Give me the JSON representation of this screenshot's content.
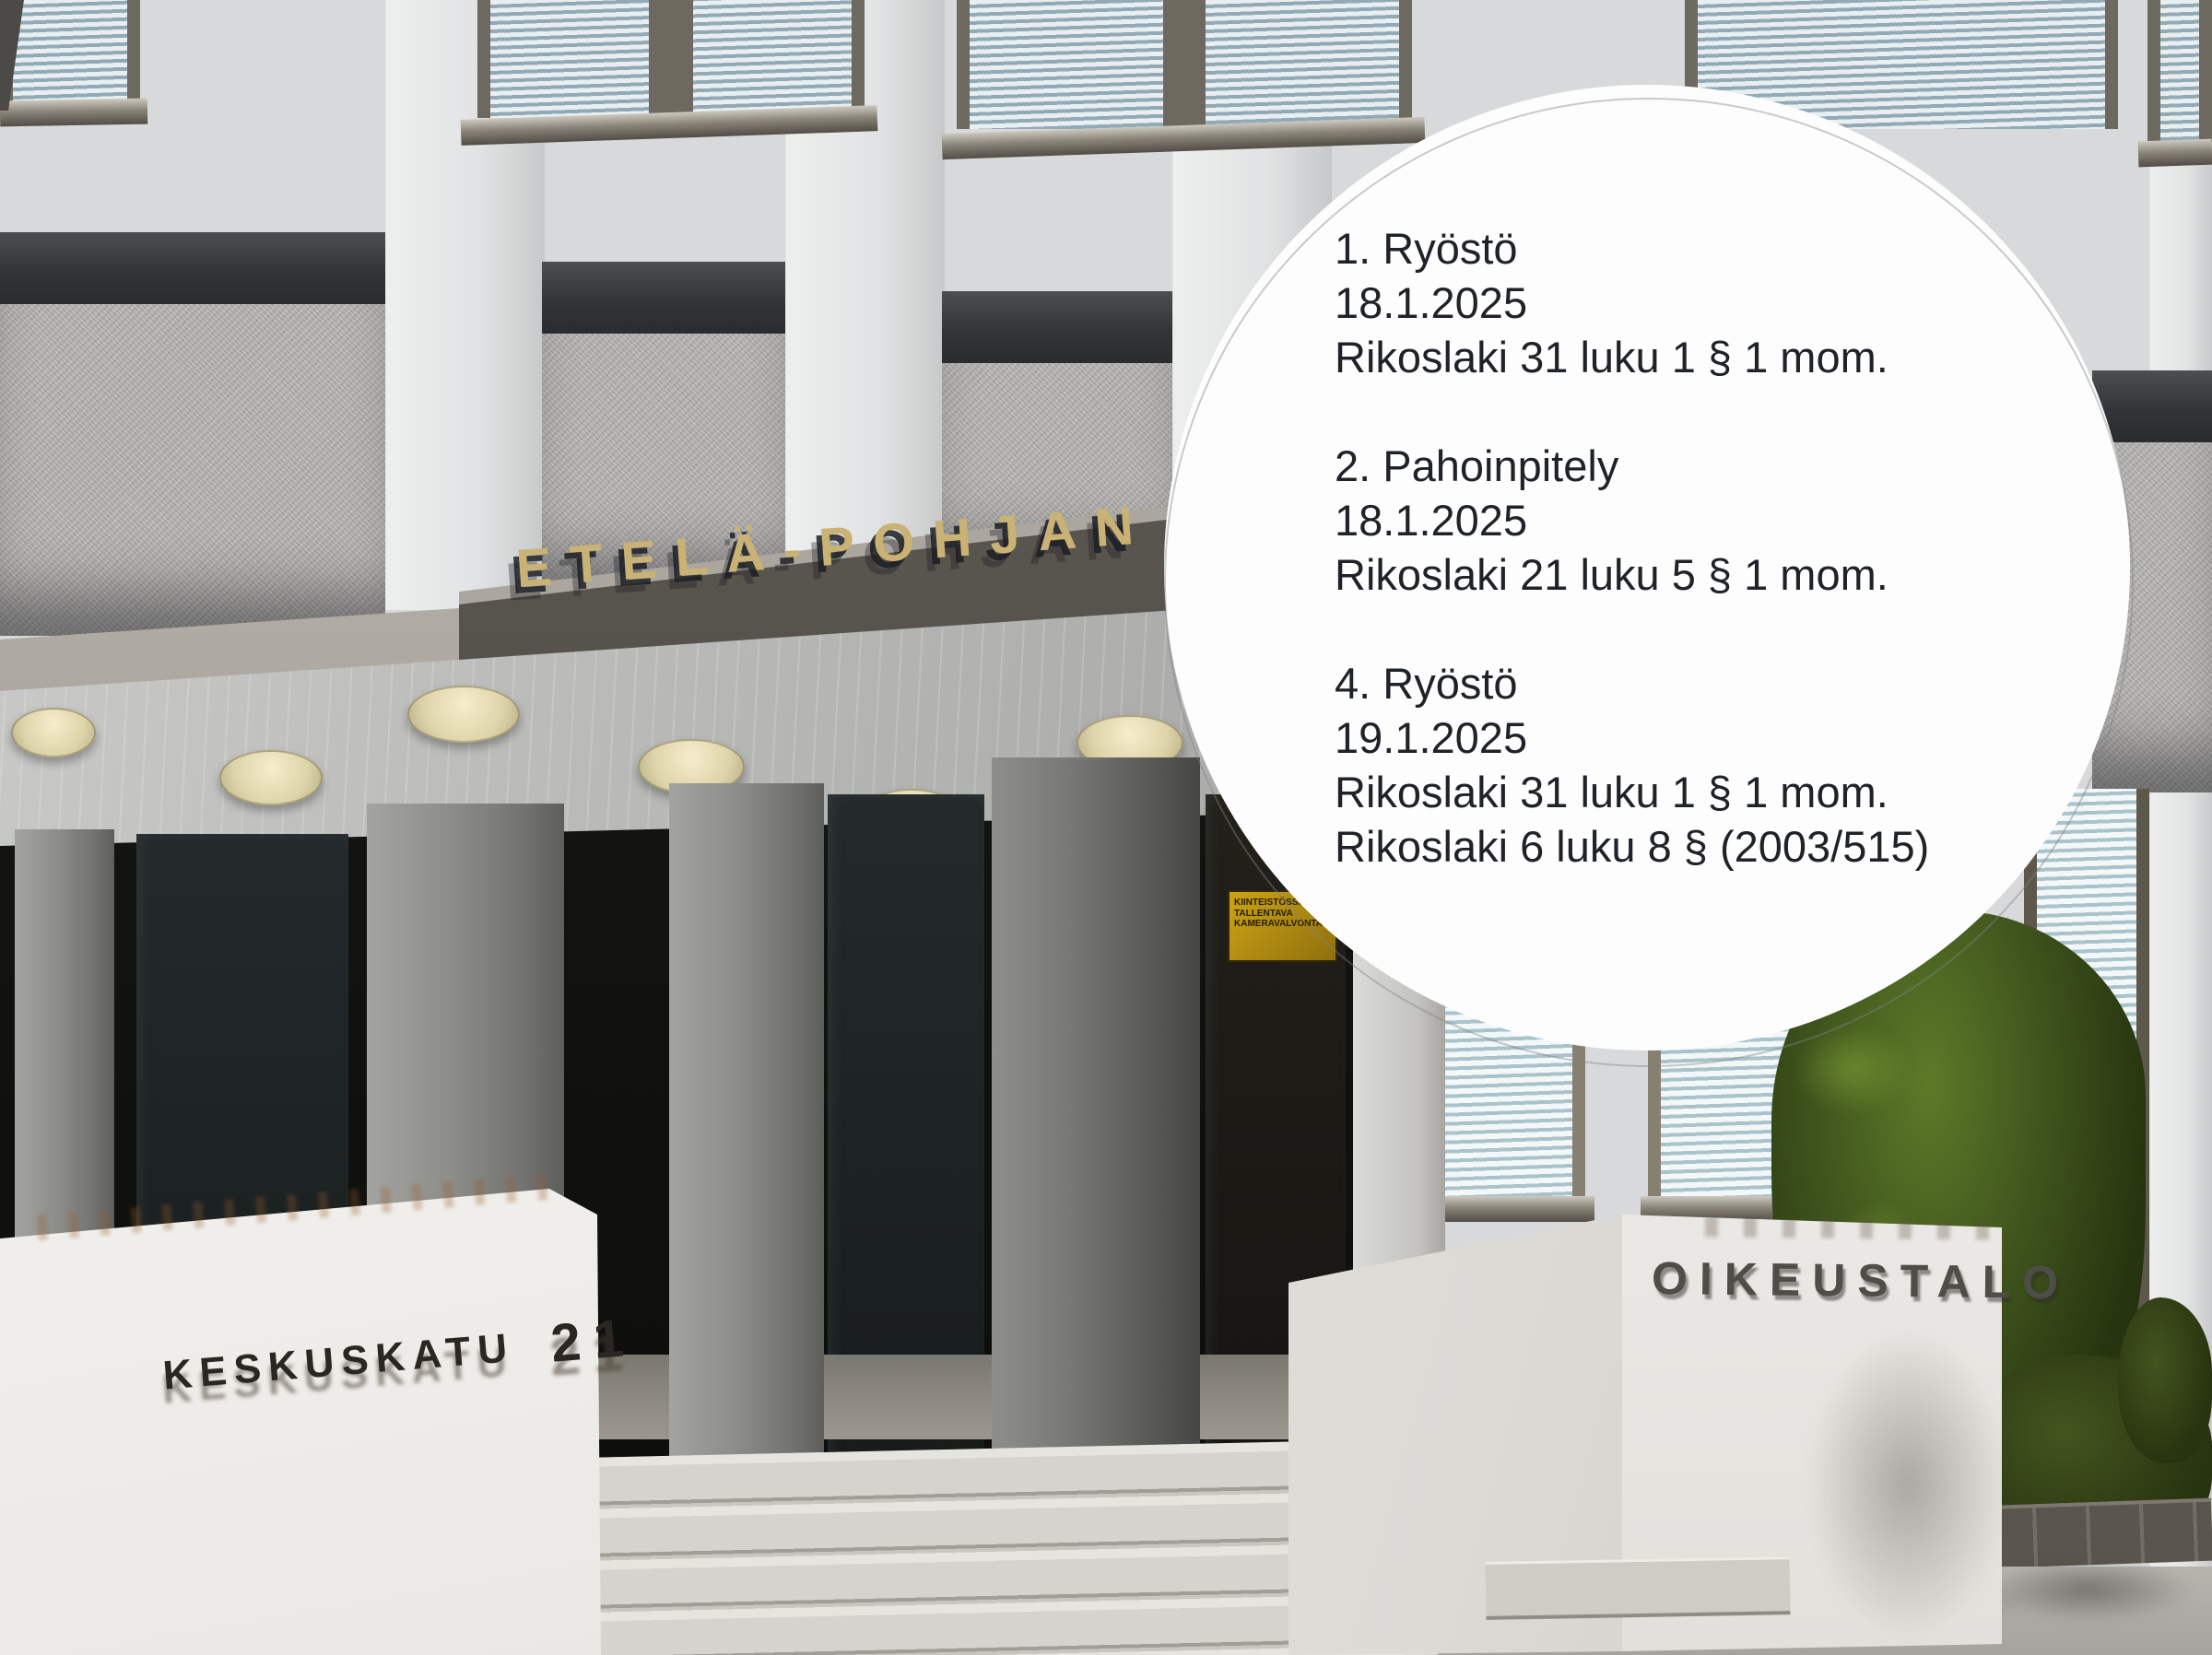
{
  "overlay": {
    "charges": [
      {
        "lines": [
          "1. Ryöstö",
          "18.1.2025",
          "Rikoslaki 31 luku 1 § 1 mom."
        ]
      },
      {
        "lines": [
          "2. Pahoinpitely",
          "18.1.2025",
          "Rikoslaki 21 luku 5 § 1 mom."
        ]
      },
      {
        "lines": [
          "4. Ryöstö",
          "19.1.2025",
          "Rikoslaki 31 luku 1 § 1 mom.",
          "Rikoslaki 6 luku 8 § (2003/515)"
        ]
      }
    ]
  },
  "signs": {
    "canopy_sign": "ETELÄ-POHJAN",
    "street_sign": {
      "name": "KESKUSKATU",
      "number": "21"
    },
    "building_sign": "OIKEUSTALO",
    "camera_warning": {
      "lines": [
        "KIINTEISTÖSSÄ",
        "TALLENTAVA",
        "KAMERAVALVONTA"
      ]
    }
  },
  "colors": {
    "circle_background": "#fdfdfd",
    "charge_text": "#1f2226",
    "canopy_gold": "#c9b273",
    "warning_yellow": "#cda315",
    "tree_green": "#3f541d",
    "facade_gray": "#d7d9da"
  }
}
